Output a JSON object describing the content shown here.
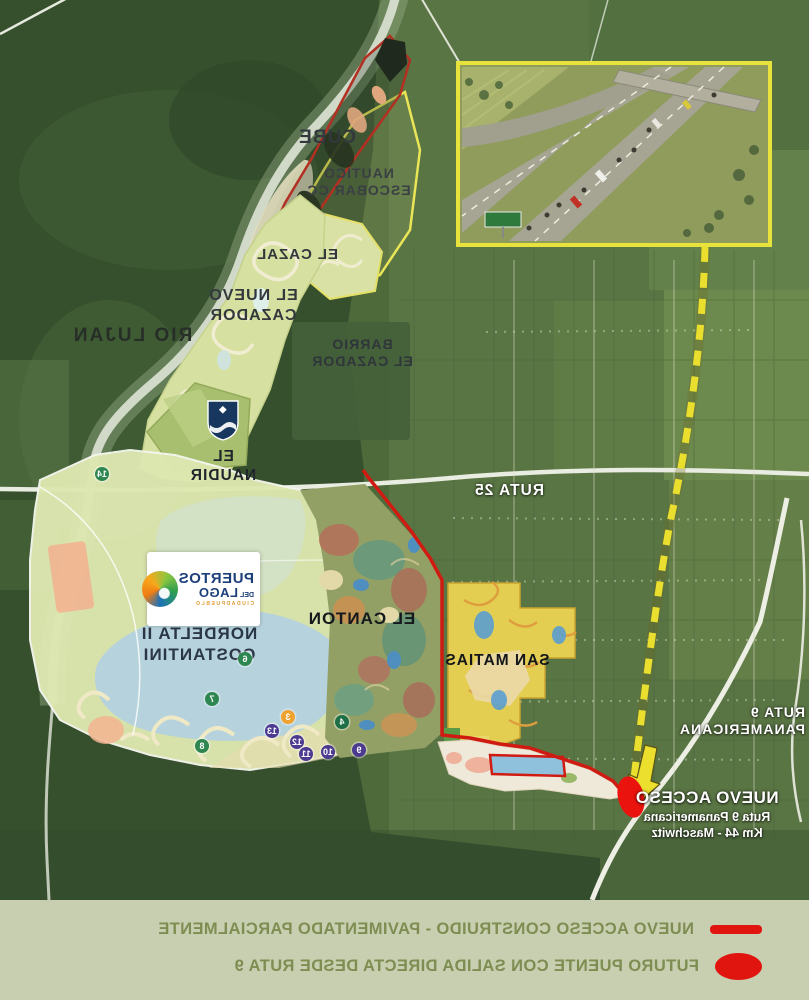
{
  "map": {
    "labels": {
      "rio_lujan": "RIO LUJAN",
      "cube": "CUBE",
      "nautico_escobar": "NAUTICO\nESCOBAR CC",
      "el_cazal": "EL CAZAL",
      "el_nuevo_cazador": "EL NUEVO\nCAZADOR",
      "barrio_el_cazador": "BARRIO\nEL CAZADOR",
      "ruta_25": "RUTA 25",
      "el_naudir": "EL NAUDIR",
      "nordelta": "NORDELTA II\nCOSTANTINI",
      "el_canton": "EL CANTON",
      "san_matias": "SAN MATIAS",
      "ruta_9": "RUTA 9\nPANAMERICANA"
    },
    "nuevo_acceso": {
      "title": "NUEVO ACCESO",
      "line2": "Ruta 9 Panamericana",
      "line3": "Km 44 - Maschwitz"
    },
    "logo": {
      "line1": "PUERTOS",
      "del": "DEL",
      "line2": "LAGO",
      "subtitle": "CIUDADPUEBLO"
    },
    "badges": [
      {
        "n": "14",
        "color": "#2e8650"
      },
      {
        "n": "6",
        "color": "#2e8650"
      },
      {
        "n": "7",
        "color": "#2e8650"
      },
      {
        "n": "8",
        "color": "#2e8650"
      },
      {
        "n": "3",
        "color": "#efa22d"
      },
      {
        "n": "4",
        "color": "#1e6f45"
      },
      {
        "n": "13",
        "color": "#4b3a90"
      },
      {
        "n": "12",
        "color": "#4b3a90"
      },
      {
        "n": "11",
        "color": "#4b3a90"
      },
      {
        "n": "10",
        "color": "#4b3a90"
      },
      {
        "n": "9",
        "color": "#4b3a90"
      }
    ]
  },
  "legend": {
    "items": [
      {
        "symbol": "line",
        "label": "NUEVO ACCESO CONSTRUIDO - PAVIMENTADO PARCIALMENTE",
        "color": "#e11510"
      },
      {
        "symbol": "ellipse",
        "label": "FUTURO PUENTE CON SALIDA DIRECTA DESDE RUTA 9",
        "color": "#e11510"
      }
    ]
  },
  "colors": {
    "boundary_red": "#cf1b12",
    "route_dash_yellow": "#eadf2e",
    "nautico_outline_yellow": "#e9e557",
    "cube_outline_red": "#b23022",
    "legend_bg": "#c8cfb0",
    "legend_text": "#7e8d51",
    "bridge_marker_red": "#ea130d"
  }
}
